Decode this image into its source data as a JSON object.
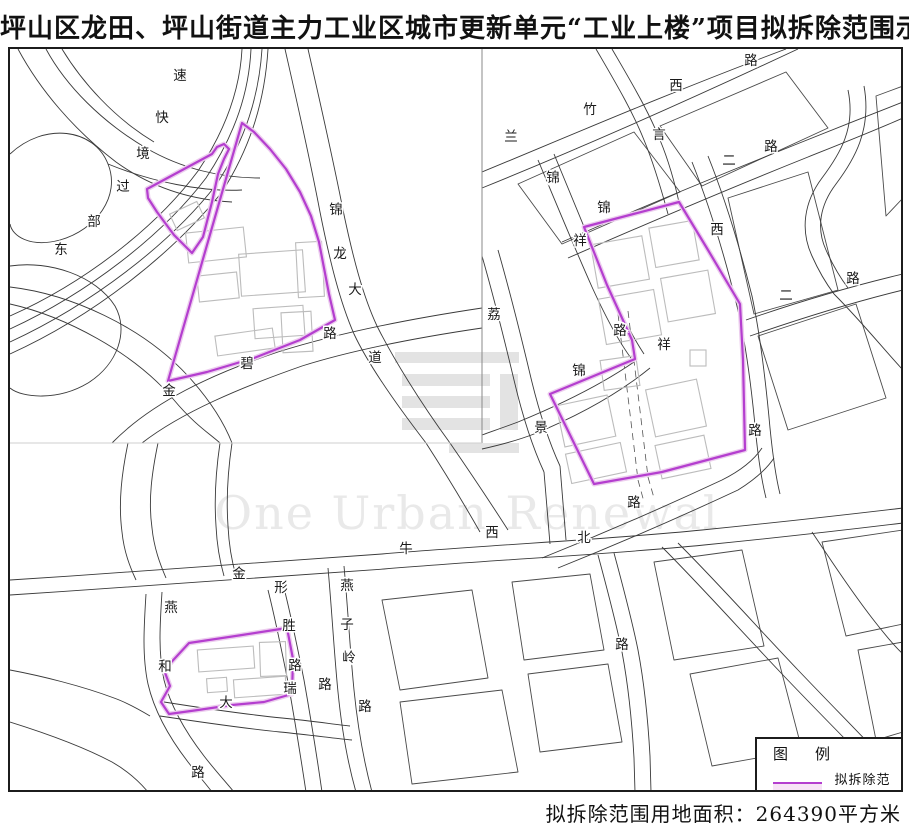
{
  "title": "坪山区龙田、坪山街道主力工业区城市更新单元“工业上楼”项目拟拆除范围示意图",
  "legend": {
    "title": "图　例",
    "item_label": "拟拆除范围"
  },
  "footer": {
    "area_text": "拟拆除范围用地面积：264390平方米"
  },
  "watermark": {
    "text": "One Urban Renewal",
    "x": 465,
    "y": 527,
    "font_size": 46
  },
  "colors": {
    "demolition": "#b43ecf",
    "demolition_halo": "#eccdee",
    "road": "#3a3a3a",
    "block": "#4a4a4a",
    "building": "#bcbcbc",
    "watermark": "#e9e9e9",
    "logo": "#e3e3e3",
    "divider": "#888",
    "divider_faint": "#cfcfcf"
  },
  "map": {
    "road_labels": [
      {
        "t": "速",
        "x": 178,
        "y": 78
      },
      {
        "t": "快",
        "x": 160,
        "y": 120
      },
      {
        "t": "境",
        "x": 141,
        "y": 156
      },
      {
        "t": "过",
        "x": 121,
        "y": 189
      },
      {
        "t": "部",
        "x": 92,
        "y": 224
      },
      {
        "t": "东",
        "x": 59,
        "y": 252
      },
      {
        "t": "锦",
        "x": 334,
        "y": 212
      },
      {
        "t": "龙",
        "x": 338,
        "y": 256
      },
      {
        "t": "大",
        "x": 353,
        "y": 292
      },
      {
        "t": "道",
        "x": 373,
        "y": 360
      },
      {
        "t": "路",
        "x": 328,
        "y": 336
      },
      {
        "t": "碧",
        "x": 245,
        "y": 366
      },
      {
        "t": "金",
        "x": 167,
        "y": 393
      },
      {
        "t": "兰",
        "x": 509,
        "y": 139
      },
      {
        "t": "竹",
        "x": 588,
        "y": 112
      },
      {
        "t": "西",
        "x": 674,
        "y": 88
      },
      {
        "t": "路",
        "x": 749,
        "y": 63
      },
      {
        "t": "言",
        "x": 657,
        "y": 137
      },
      {
        "t": "二",
        "x": 727,
        "y": 163
      },
      {
        "t": "路",
        "x": 769,
        "y": 149
      },
      {
        "t": "锦",
        "x": 551,
        "y": 180
      },
      {
        "t": "祥",
        "x": 578,
        "y": 243
      },
      {
        "t": "锦",
        "x": 602,
        "y": 210
      },
      {
        "t": "路",
        "x": 618,
        "y": 333
      },
      {
        "t": "祥",
        "x": 662,
        "y": 347
      },
      {
        "t": "锦",
        "x": 577,
        "y": 373
      },
      {
        "t": "西",
        "x": 715,
        "y": 232
      },
      {
        "t": "路",
        "x": 753,
        "y": 433
      },
      {
        "t": "荔",
        "x": 492,
        "y": 317
      },
      {
        "t": "景",
        "x": 539,
        "y": 430
      },
      {
        "t": "二",
        "x": 784,
        "y": 298
      },
      {
        "t": "路",
        "x": 851,
        "y": 281
      },
      {
        "t": "牛",
        "x": 404,
        "y": 551
      },
      {
        "t": "西",
        "x": 490,
        "y": 535
      },
      {
        "t": "北",
        "x": 582,
        "y": 540
      },
      {
        "t": "路",
        "x": 632,
        "y": 505
      },
      {
        "t": "燕",
        "x": 345,
        "y": 588
      },
      {
        "t": "子",
        "x": 345,
        "y": 627
      },
      {
        "t": "岭",
        "x": 347,
        "y": 660
      },
      {
        "t": "路",
        "x": 363,
        "y": 709
      },
      {
        "t": "金",
        "x": 237,
        "y": 576
      },
      {
        "t": "形",
        "x": 279,
        "y": 590
      },
      {
        "t": "胜",
        "x": 287,
        "y": 628
      },
      {
        "t": "路",
        "x": 293,
        "y": 668
      },
      {
        "t": "瑞",
        "x": 288,
        "y": 691
      },
      {
        "t": "路",
        "x": 323,
        "y": 687
      },
      {
        "t": "燕",
        "x": 169,
        "y": 610
      },
      {
        "t": "和",
        "x": 163,
        "y": 669
      },
      {
        "t": "大",
        "x": 224,
        "y": 705
      },
      {
        "t": "路",
        "x": 196,
        "y": 775
      },
      {
        "t": "路",
        "x": 620,
        "y": 647
      }
    ],
    "roads": [
      "M8,340 C90,302 168,242 214,183 C244,137 257,93 260,47",
      "M8,327 C86,291 160,234 204,176 C234,131 247,89 249,47",
      "M8,314 C80,282 152,228 196,169 C225,126 238,86 240,47",
      "M8,352 C94,313 172,250 220,190 C250,143 263,96 266,47",
      "M16,47 C38,88 72,128 114,160 C150,186 190,198 230,200",
      "M44,47 C64,84 100,120 144,146 C180,167 220,176 258,176",
      "M60,47 C80,80 112,116 152,140",
      "M8,152 C42,120 92,126 106,162 C119,194 94,228 58,238 C28,246 10,234 8,222",
      "M8,264 C48,258 94,274 113,304 C127,329 116,362 86,381 C56,399 20,396 8,386",
      "M8,302 C62,314 132,350 172,398 C192,422 208,432 218,441",
      "M8,285 C68,292 140,324 186,374 C206,396 221,418 230,441",
      "M106,162 C150,180 200,190 240,188",
      "M283,47 C295,100 307,152 318,210 C328,260 338,300 352,332 C366,362 394,402 424,441",
      "M306,47 C318,100 330,152 341,208 C351,256 361,294 375,324 C391,356 418,400 448,441",
      "M110,441 C150,400 210,372 276,350 C330,333 400,318 480,306",
      "M140,441 C180,410 240,385 300,364 C348,349 412,336 480,326",
      "M480,170 C560,137 664,92 784,47",
      "M480,186 C564,152 670,106 796,47",
      "M610,47 C628,78 646,108 658,138 C668,162 674,186 678,205",
      "M594,47 C612,78 630,108 642,138 C652,162 660,190 666,212",
      "M560,240 C640,205 720,172 800,140 C830,128 870,112 901,100",
      "M566,256 C646,221 726,187 806,155 C836,143 874,128 901,116",
      "M536,158 C552,196 570,240 590,285 C606,320 620,345 632,360",
      "M552,152 C568,190 586,234 604,278 C618,310 630,334 642,352",
      "M632,360 C600,382 560,402 516,420 C500,426 488,430 480,433",
      "M648,366 C616,392 576,414 532,432 C514,439 498,443 480,447",
      "M480,254 C492,296 502,336 512,378 C520,412 530,444 542,470",
      "M496,248 C508,290 518,330 528,372 C536,406 546,438 558,464",
      "M690,160 C706,200 722,252 734,300 C744,340 750,390 754,434 C757,462 760,480 764,496",
      "M706,154 C722,194 738,246 750,294 C758,332 764,382 768,426 C771,456 774,476 778,492",
      "M846,88 C854,126 838,152 820,176 C802,200 798,228 810,254 C818,272 826,284 832,292",
      "M862,84 C870,128 852,158 834,182 C818,203 814,226 824,248 C832,266 840,278 846,286",
      "M744,318 C796,300 850,284 901,272",
      "M748,334 C800,316 852,300 901,288",
      "M832,292 C860,320 884,350 901,368",
      "M8,578 C130,570 250,562 380,552 C500,542 600,538 700,528 C790,519 850,512 901,506",
      "M8,593 C130,585 250,577 382,567 C502,557 602,553 702,543 C792,534 852,527 901,521",
      "M540,556 C600,532 660,506 720,478 C740,468 752,458 760,446",
      "M556,566 C616,542 676,516 736,488 C752,478 764,468 772,456",
      "M326,566 C330,610 332,650 336,690 C340,730 346,762 354,790",
      "M342,564 C346,608 348,648 352,688 C356,728 362,760 370,790",
      "M266,588 C274,620 280,650 286,680 C292,714 298,750 304,790",
      "M282,586 C290,618 296,648 302,678 C308,712 314,748 320,790",
      "M144,592 C142,624 140,654 146,682 C152,708 166,734 186,760 C196,773 204,782 210,790",
      "M160,590 C158,622 156,650 162,678 C168,702 182,728 202,754 C212,767 222,778 232,790",
      "M162,700 C200,706 240,712 280,716 C310,719 330,722 348,724",
      "M158,714 C198,720 238,726 278,730 C308,733 330,736 350,738",
      "M424,441 C444,472 462,502 478,530",
      "M448,441 C468,470 488,500 506,528",
      "M126,441 C120,470 116,500 120,530 C122,550 128,565 134,578",
      "M156,441 C150,470 146,498 150,526 C152,546 158,562 164,576",
      "M218,441 C214,468 212,496 214,524 C215,545 218,560 222,574",
      "M230,441 C226,468 224,496 226,524 C227,545 230,560 234,574",
      "M542,470 C544,495 546,520 548,542",
      "M558,464 C560,490 562,515 564,538",
      "M596,553 C606,590 614,620 620,650 C626,682 630,720 632,756 L633,790",
      "M612,551 C622,588 630,618 636,648 C642,680 646,718 648,754 L649,790",
      "M660,545 C700,585 740,630 780,672 C820,714 860,754 895,790",
      "M676,541 C716,581 756,626 796,668 C836,710 876,750 901,778",
      "M810,530 C830,560 850,590 870,616 C884,634 894,646 901,652",
      "M8,668 C40,674 80,684 112,696 C126,701 138,708 148,714",
      "M8,720 C40,730 80,744 110,760 C124,768 136,778 146,790"
    ],
    "dashed_roads": [
      "M616,312 L636,478",
      "M626,309 L646,475",
      "M636,478 L642,500",
      "M646,475 L652,496"
    ],
    "blocks": [
      "516,182 632,130 678,190 560,242",
      "658,124 784,70 826,126 700,184",
      "874,94 901,84 901,196 884,214",
      "726,196 806,170 836,288 752,312",
      "756,334 854,302 884,396 786,428",
      "380,598 470,588 486,676 398,688",
      "398,700 500,688 516,770 410,782",
      "510,580 588,572 602,648 522,658",
      "526,672 606,662 620,740 538,750",
      "652,560 740,548 762,644 672,658",
      "688,672 776,656 800,748 710,764",
      "820,540 901,528 901,622 844,634",
      "856,648 901,640 901,730 874,738"
    ],
    "buildings": [
      {
        "x": 185,
        "y": 228,
        "w": 58,
        "h": 30,
        "r": -6
      },
      {
        "x": 196,
        "y": 272,
        "w": 40,
        "h": 26,
        "r": -6
      },
      {
        "x": 238,
        "y": 250,
        "w": 64,
        "h": 42,
        "r": -4
      },
      {
        "x": 252,
        "y": 305,
        "w": 50,
        "h": 30,
        "r": -4
      },
      {
        "x": 295,
        "y": 240,
        "w": 26,
        "h": 55,
        "r": -3
      },
      {
        "x": 214,
        "y": 330,
        "w": 58,
        "h": 20,
        "r": -8
      },
      {
        "x": 170,
        "y": 205,
        "w": 30,
        "h": 18,
        "r": -25
      },
      {
        "x": 280,
        "y": 310,
        "w": 30,
        "h": 40,
        "r": -3
      },
      {
        "x": 592,
        "y": 238,
        "w": 52,
        "h": 44,
        "r": -10
      },
      {
        "x": 650,
        "y": 222,
        "w": 44,
        "h": 40,
        "r": -10
      },
      {
        "x": 600,
        "y": 292,
        "w": 56,
        "h": 46,
        "r": -10
      },
      {
        "x": 662,
        "y": 272,
        "w": 48,
        "h": 44,
        "r": -10
      },
      {
        "x": 558,
        "y": 398,
        "w": 52,
        "h": 42,
        "r": -12
      },
      {
        "x": 566,
        "y": 446,
        "w": 56,
        "h": 30,
        "r": -12
      },
      {
        "x": 648,
        "y": 382,
        "w": 52,
        "h": 48,
        "r": -12
      },
      {
        "x": 656,
        "y": 438,
        "w": 50,
        "h": 34,
        "r": -12
      },
      {
        "x": 600,
        "y": 356,
        "w": 36,
        "h": 30,
        "r": -8
      },
      {
        "x": 688,
        "y": 348,
        "w": 16,
        "h": 16,
        "r": 0
      },
      {
        "x": 196,
        "y": 646,
        "w": 56,
        "h": 22,
        "r": -4
      },
      {
        "x": 232,
        "y": 676,
        "w": 52,
        "h": 18,
        "r": -4
      },
      {
        "x": 258,
        "y": 640,
        "w": 26,
        "h": 34,
        "r": -2
      },
      {
        "x": 205,
        "y": 676,
        "w": 20,
        "h": 14,
        "r": -4
      }
    ],
    "demolition_polygons": [
      "240,121 252,130 268,147 284,167 298,190 309,214 317,240 322,266 327,292 333,318 298,338 252,356 205,370 166,379",
      "145,187 210,152 215,145 222,142 227,147 222,157 216,172 210,200 201,235 190,251 172,233 155,210 146,196",
      "582,225 677,200 706,248 738,302 741,358 743,448 660,470 592,482 548,392 633,357 630,338 605,283",
      "187,641 240,633 285,626 291,657 290,692 262,700 230,703 196,708 167,712 159,700 168,684 162,668 175,654"
    ],
    "logo_bars": [
      {
        "x": 393,
        "y": 350,
        "w": 124,
        "h": 11
      },
      {
        "x": 400,
        "y": 372,
        "w": 88,
        "h": 12
      },
      {
        "x": 400,
        "y": 394,
        "w": 88,
        "h": 12
      },
      {
        "x": 400,
        "y": 416,
        "w": 88,
        "h": 12
      },
      {
        "x": 498,
        "y": 372,
        "w": 18,
        "h": 56
      },
      {
        "x": 447,
        "y": 441,
        "w": 70,
        "h": 10
      }
    ],
    "dividers": {
      "vertical": {
        "x": 480,
        "y1": 47,
        "y2": 441
      },
      "horizontal": {
        "y": 441,
        "x1": 8,
        "x2": 480
      }
    }
  }
}
